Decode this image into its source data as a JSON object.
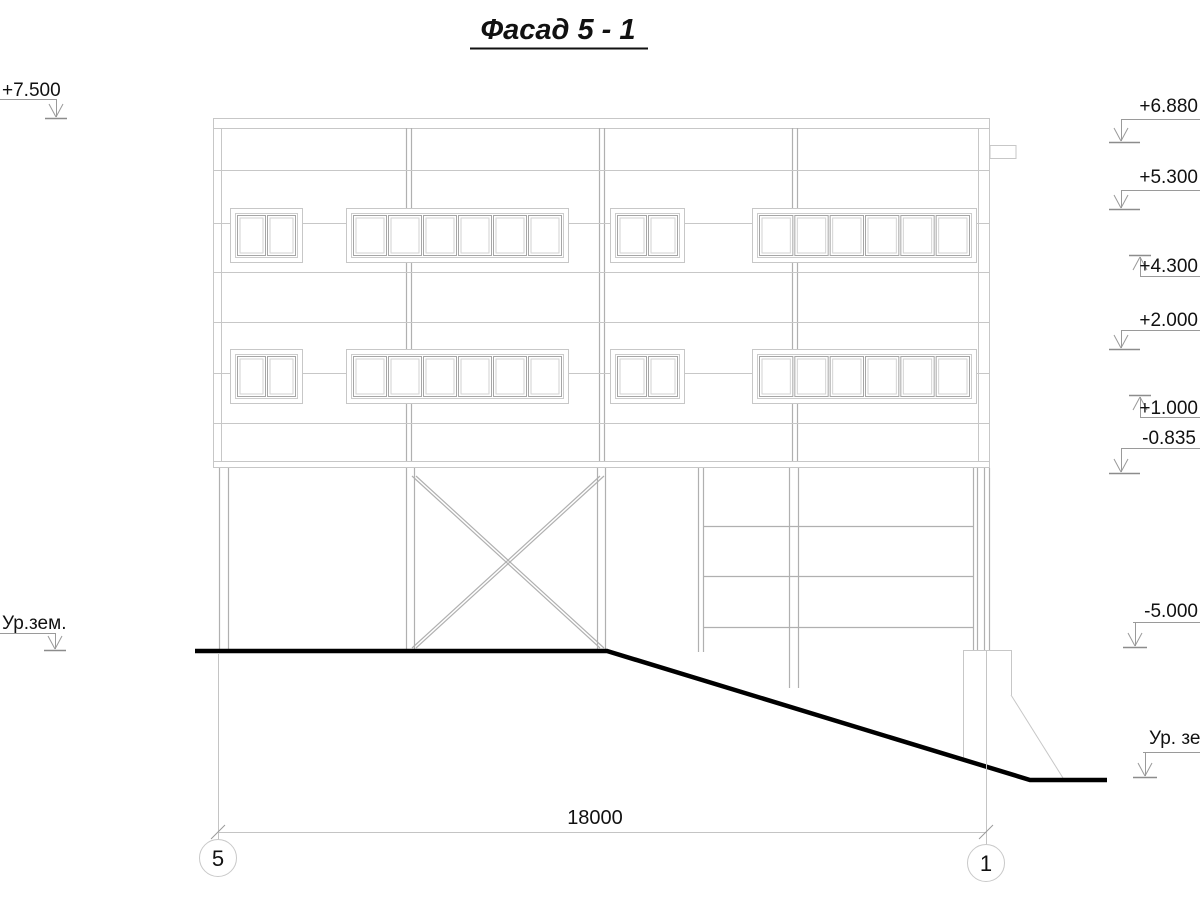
{
  "title": "Фасад 5 - 1",
  "marks": {
    "left_top": "+7.500",
    "left_ground": "Ур.зем.",
    "r1": "+6.880",
    "r2": "+5.300",
    "r3": "+4.300",
    "r4": "+2.000",
    "r5": "+1.000",
    "r6": "-0.835",
    "r7": "-5.000",
    "right_ground": "Ур. зе"
  },
  "dimension": {
    "total": "18000"
  },
  "axes": {
    "left": "5",
    "right": "1"
  },
  "colors": {
    "drawing_line": "#c7c7c7",
    "detail_line": "#b0b0b0",
    "marker_line": "#9a9a9a",
    "ground_line": "#000000",
    "text_color": "#111111"
  }
}
